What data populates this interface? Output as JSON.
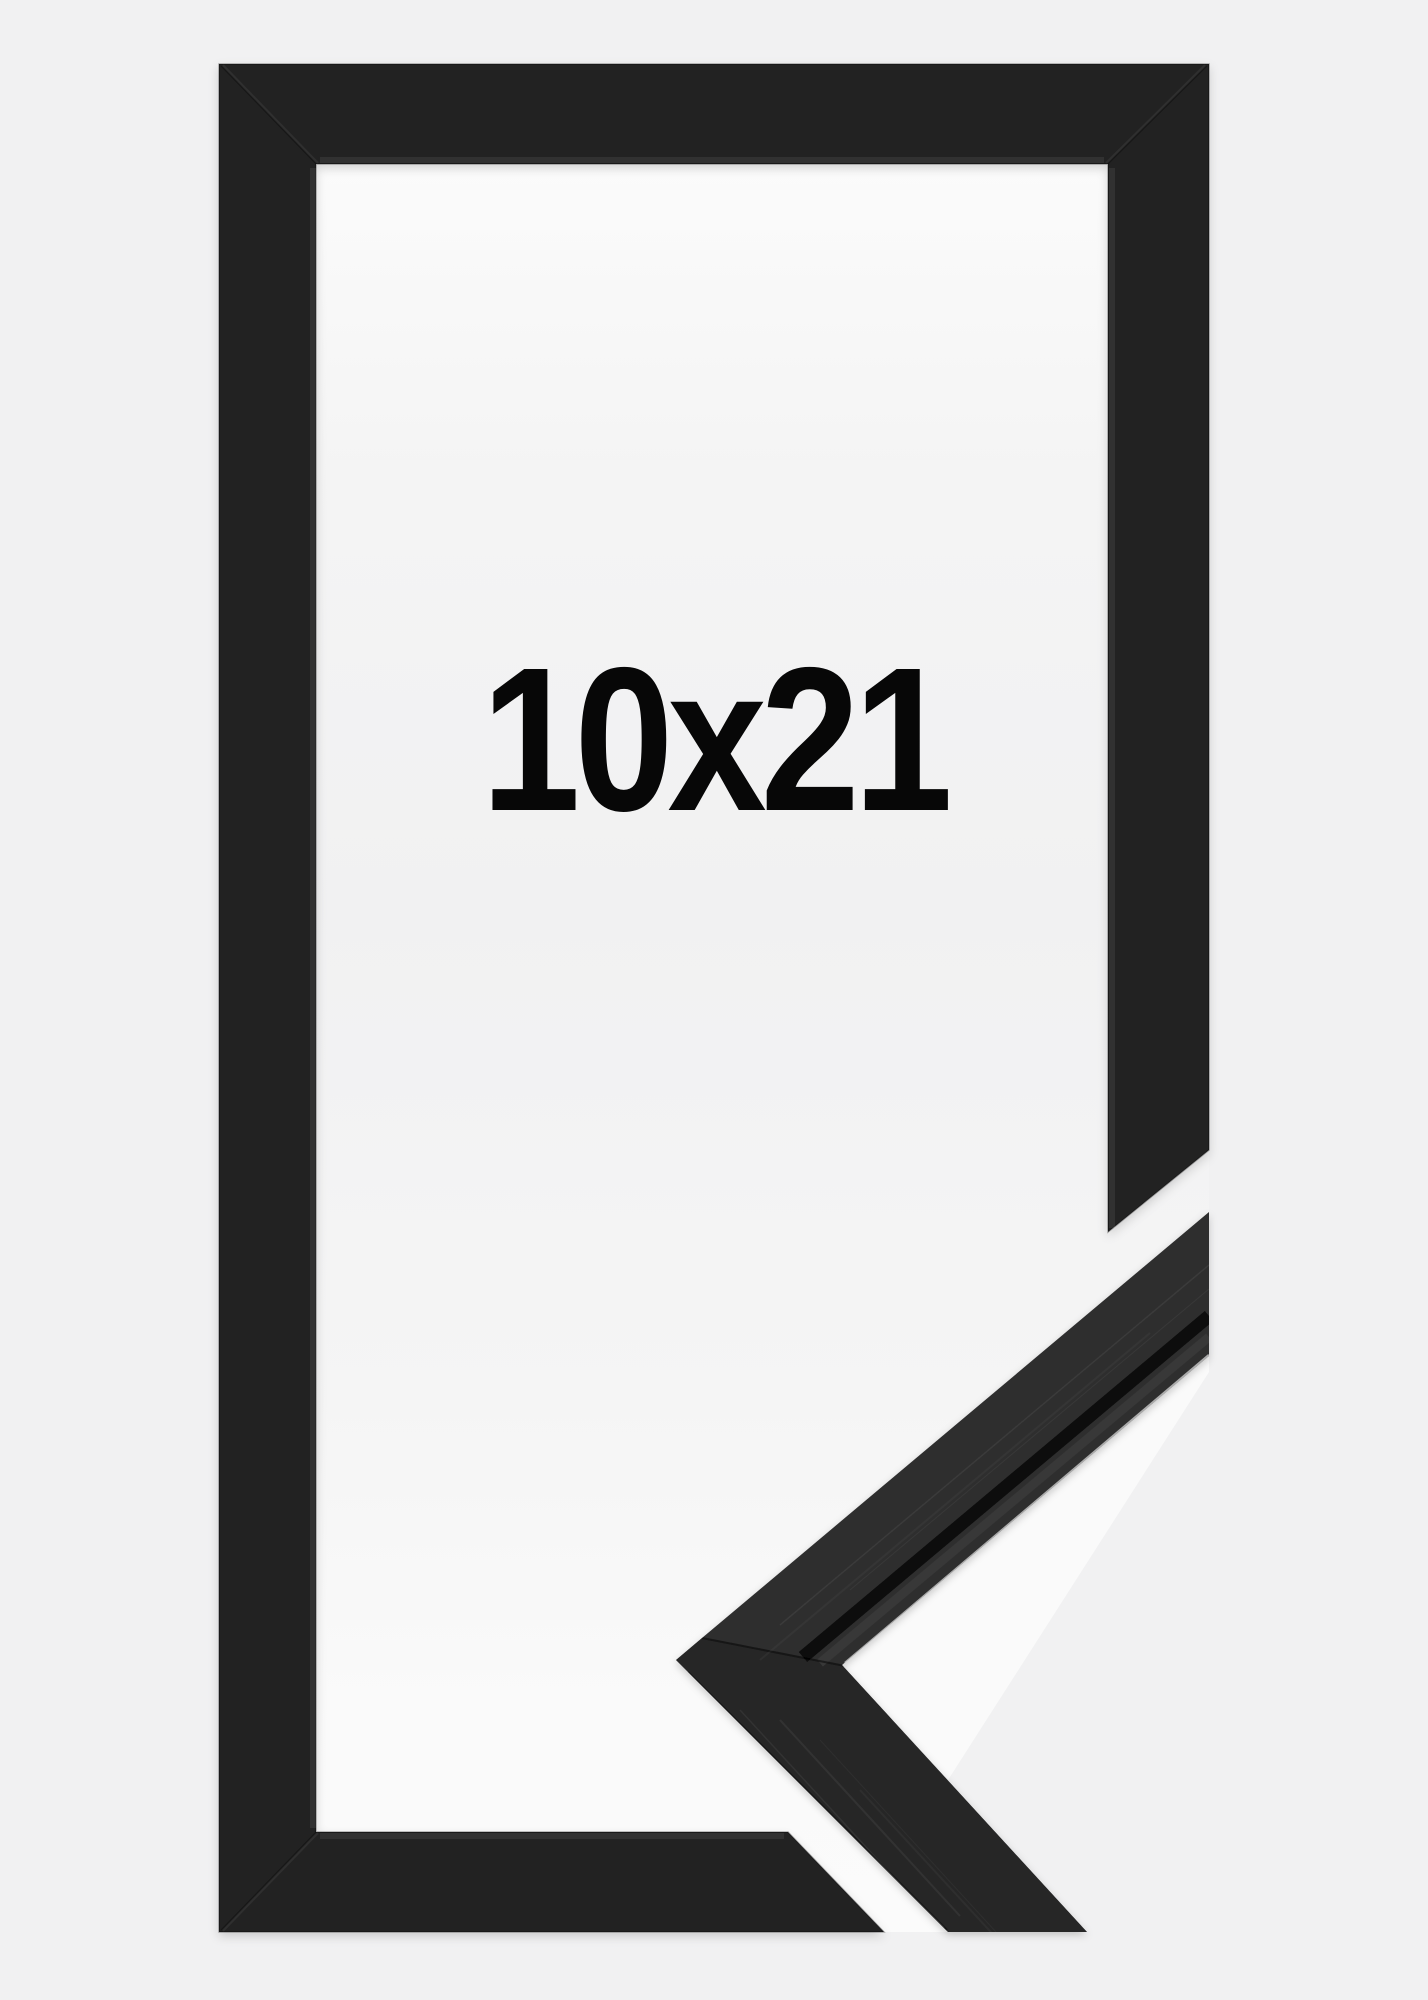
{
  "product": {
    "size_label": "10x21",
    "description": "Black narrow wooden picture frame shown front-on with a diagonal cut-away in the lower right revealing a close-up of the mitered corner moulding profile"
  },
  "photo": {
    "background_color": "#f1f1f2",
    "backing_color": "#f9f9f9",
    "frame_color": "#232323",
    "corner_profile_color": "#2e2e2e",
    "label_color": "#070707"
  }
}
